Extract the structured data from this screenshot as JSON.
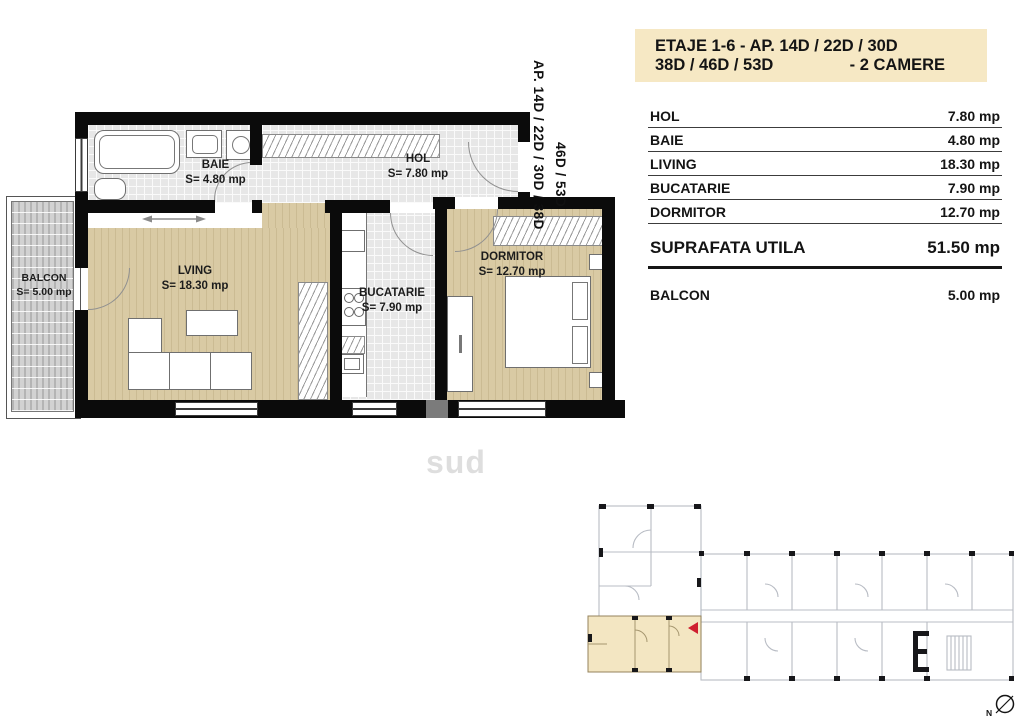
{
  "header": {
    "line1": "ETAJE 1-6 -  AP.  14D / 22D / 30D",
    "line2_left": "38D / 46D / 53D",
    "line2_right": "- 2 CAMERE"
  },
  "table": {
    "rows": [
      {
        "label": "HOL",
        "value": "7.80 mp"
      },
      {
        "label": "BAIE",
        "value": "4.80 mp"
      },
      {
        "label": "LIVING",
        "value": "18.30 mp"
      },
      {
        "label": "BUCATARIE",
        "value": "7.90 mp"
      },
      {
        "label": "DORMITOR",
        "value": "12.70 mp"
      }
    ]
  },
  "summary": {
    "label": "SUPRAFATA UTILA",
    "value": "51.50 mp"
  },
  "balcony": {
    "label": "BALCON",
    "value": "5.00 mp"
  },
  "plan": {
    "rooms": {
      "baie": {
        "name": "BAIE",
        "area": "S= 4.80 mp"
      },
      "hol": {
        "name": "HOL",
        "area": "S= 7.80 mp"
      },
      "living": {
        "name": "LVING",
        "area": "S= 18.30 mp"
      },
      "bucatarie": {
        "name": "BUCATARIE",
        "area": "S= 7.90 mp"
      },
      "dormitor": {
        "name": "DORMITOR",
        "area": "S= 12.70 mp"
      },
      "balcon": {
        "name": "BALCON",
        "area": "S= 5.00 mp"
      }
    },
    "side_label_1": "AP. 14D / 22D / 30D / 38D",
    "side_label_2": "46D / 53D",
    "watermark": "sud",
    "compass": "N"
  },
  "colors": {
    "header_bg": "#f6e8c4",
    "wall": "#0b0b0b",
    "wood_floor": "#d9caa4",
    "tile_floor": "#e7e7e7",
    "balcony_deck": "#d2d2d2",
    "keyplan_highlight": "#f3e6c2",
    "keyplan_lines": "#b8bcc4",
    "marker_red": "#cf1f2f"
  }
}
